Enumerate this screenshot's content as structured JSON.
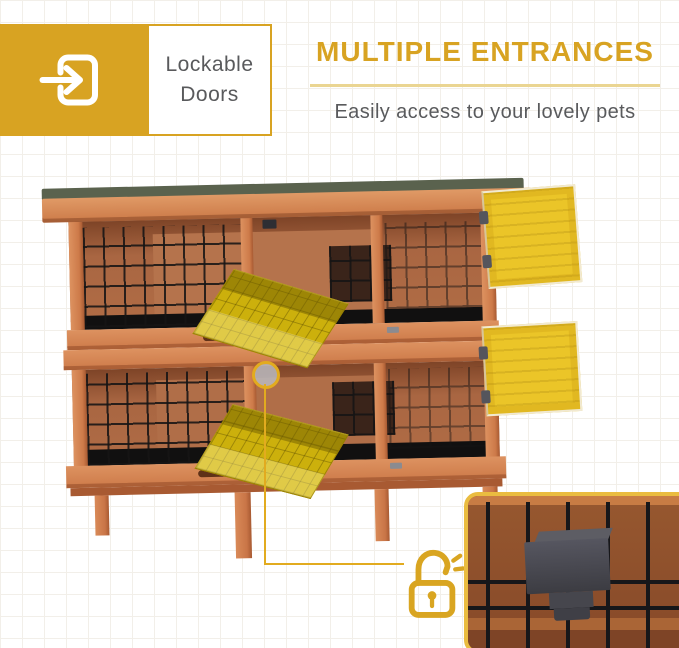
{
  "feature_badge": {
    "label": "Lockable Doors"
  },
  "header": {
    "title": "MULTIPLE ENTRANCES",
    "subtitle": "Easily access to your lovely pets"
  },
  "icons": {
    "badge_icon": "enter-door-arrow-icon",
    "callout_icon": "unlock-padlock-icon"
  },
  "colors": {
    "brand_gold": "#d8a322",
    "underline_gold": "#ead592",
    "text_gray": "#595a5c",
    "callout_gold": "#e2ab1f",
    "door_yellow": "#ebc528",
    "inset_border": "#eabc40",
    "grid_line": "#f2efe9"
  }
}
